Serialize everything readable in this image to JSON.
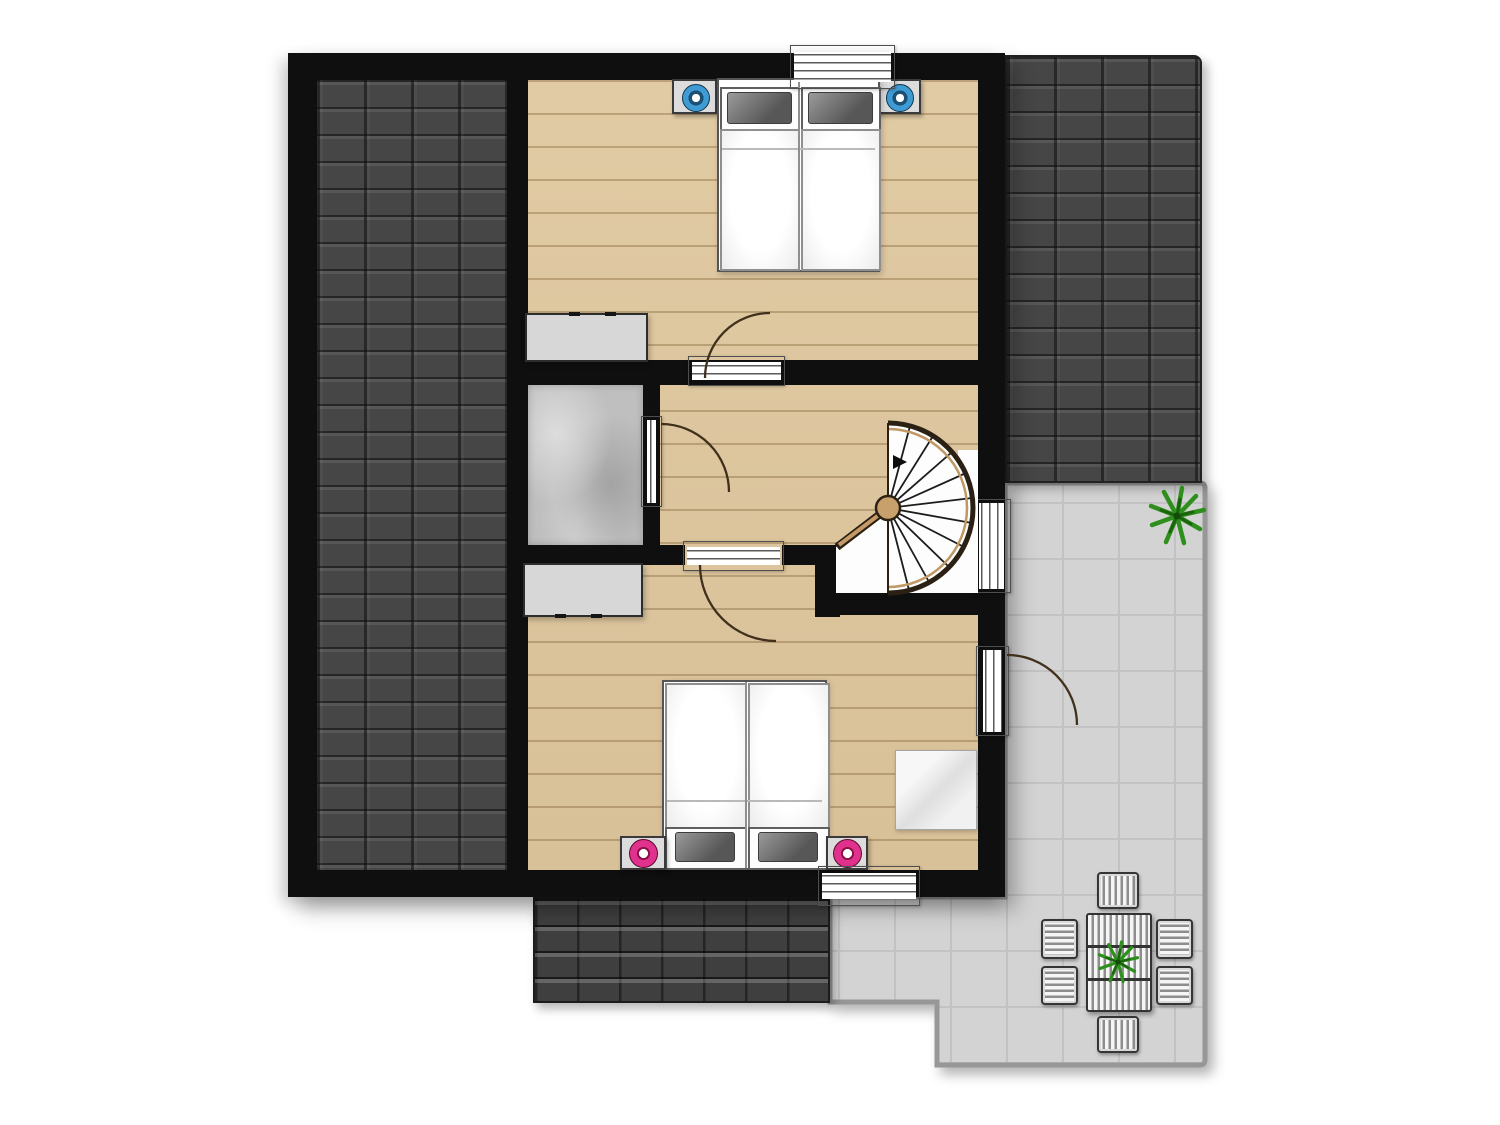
{
  "plan": {
    "type": "floor-plan",
    "level": "attic-storey",
    "visible_text": [],
    "rooms": [
      {
        "id": "bedroom-north",
        "floor": "wood",
        "furniture": [
          "double-bed",
          "nightstand-left-blue-lamp",
          "nightstand-right-blue-lamp",
          "dresser"
        ]
      },
      {
        "id": "hallway",
        "floor": "wood"
      },
      {
        "id": "bathroom",
        "floor": "gray-stone"
      },
      {
        "id": "stair-landing",
        "floor": "white",
        "furniture": [
          "spiral-staircase",
          "up-arrow"
        ]
      },
      {
        "id": "bedroom-south",
        "floor": "wood",
        "furniture": [
          "double-bed",
          "nightstand-left-pink-lamp",
          "nightstand-right-pink-lamp",
          "dresser",
          "side-table"
        ]
      },
      {
        "id": "terrace",
        "floor": "gray-tiles",
        "furniture": [
          "dining-table",
          "chair-top",
          "chair-bottom",
          "chair-left-1",
          "chair-left-2",
          "chair-right-1",
          "chair-right-2",
          "potted-plant-corner",
          "potted-plant-table"
        ]
      }
    ],
    "roof_areas": [
      "west-roof-tiled",
      "north-east-roof-tiled",
      "south-roof-tiled"
    ],
    "openings": {
      "windows": [
        "north-window",
        "east-stair-window",
        "south-window"
      ],
      "doors": [
        "bedroom-north-door",
        "bathroom-door",
        "bedroom-south-door",
        "terrace-door"
      ]
    }
  },
  "colors": {
    "wall": "#0f0f0f",
    "wood": "#dcc59e",
    "roof": "#464646",
    "terrace": "#d3d3d3",
    "terrace-line": "#c2c2c2",
    "terrace-border": "#979797",
    "bath": "#bfbfbf",
    "furniture-gray": "#d7d7d7",
    "accent-blue": "#3f9bd3",
    "accent-blue-dark": "#1c5075",
    "accent-pink": "#e0318c",
    "plant": "#2e8f1d",
    "plant-dark": "#1b640d",
    "stair-outline": "#2a2014",
    "stair-wood": "#c59a66",
    "door-arc": "#40301c"
  }
}
